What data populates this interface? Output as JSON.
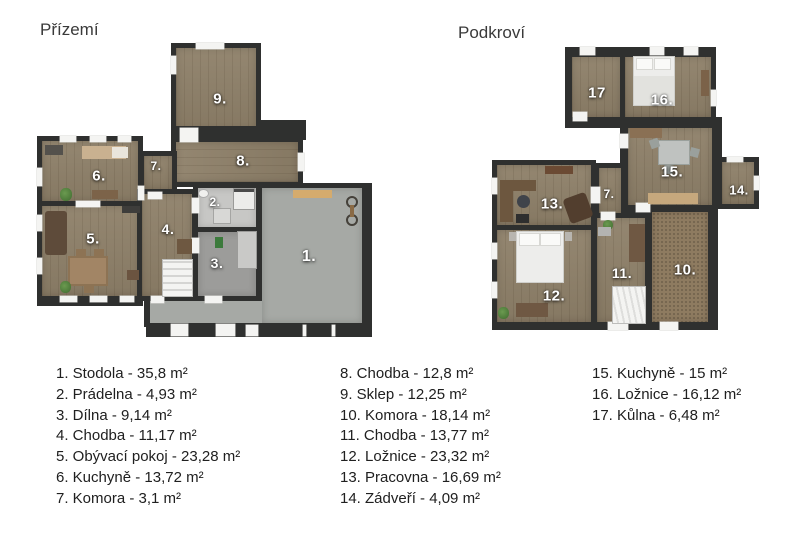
{
  "ground": {
    "title": "Přízemí",
    "labels": {
      "r1": "1.",
      "r2": "2.",
      "r3": "3.",
      "r4": "4.",
      "r5": "5.",
      "r6": "6.",
      "r7": "7.",
      "r8": "8.",
      "r9": "9."
    }
  },
  "attic": {
    "title": "Podkroví",
    "labels": {
      "r7": "7.",
      "r10": "10.",
      "r11": "11.",
      "r12": "12.",
      "r13": "13.",
      "r14": "14.",
      "r15": "15.",
      "r16": "16.",
      "r17": "17"
    }
  },
  "legend": {
    "columns": [
      {
        "items": [
          "1. Stodola - 35,8 m²",
          "2. Prádelna - 4,93 m²",
          "3. Dílna - 9,14 m²",
          "4. Chodba - 11,17 m²",
          "5. Obývací pokoj - 23,28 m²",
          "6. Kuchyně - 13,72 m²",
          "7. Komora - 3,1 m²"
        ]
      },
      {
        "items": [
          "8. Chodba - 12,8 m²",
          "9. Sklep - 12,25 m²",
          "10. Komora - 18,14 m²",
          "11. Chodba - 13,77 m²",
          "12. Ložnice - 23,32 m²",
          "13. Pracovna - 16,69 m²",
          "14. Zádveří - 4,09 m²"
        ]
      },
      {
        "items": [
          "15. Kuchyně - 15 m²",
          "16. Ložnice - 16,12 m²",
          "17. Kůlna - 6,48 m²"
        ]
      }
    ]
  },
  "colors": {
    "wall": "#2f302f",
    "wood": "#8e8069",
    "concrete": "#a6a9a5"
  }
}
